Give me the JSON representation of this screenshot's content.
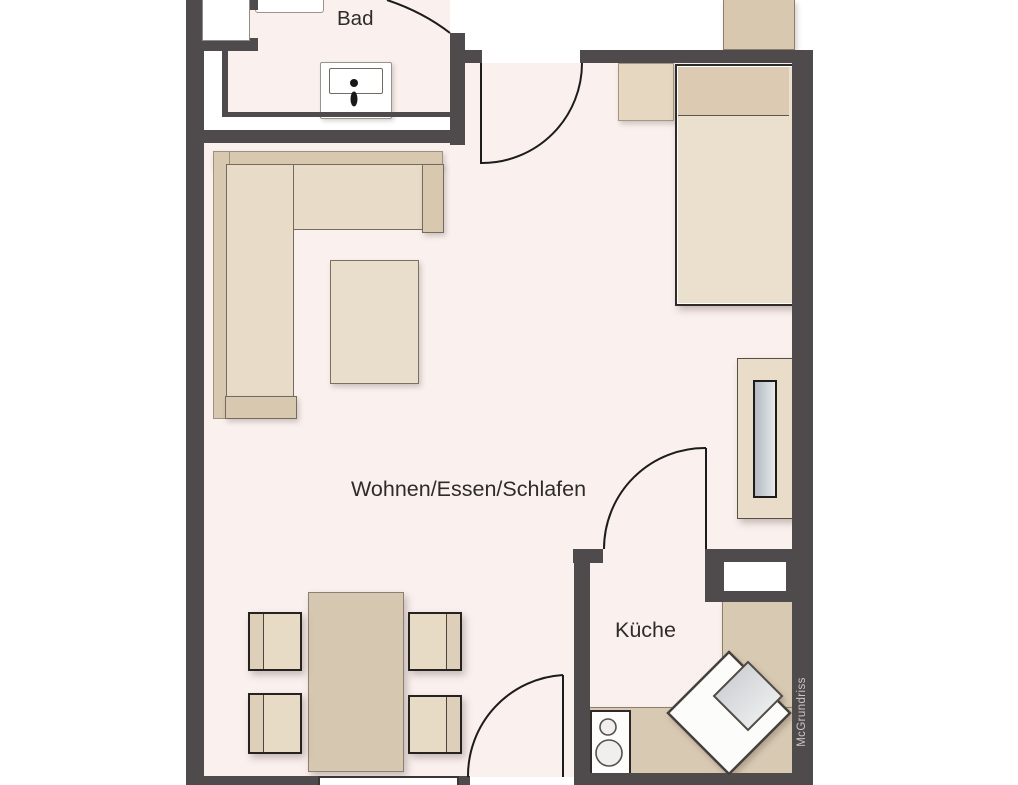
{
  "palette": {
    "background": "#ffffff",
    "floor": "#faf0ee",
    "wall": "#4f4b4c",
    "furniture_dark": "#d8c8b0",
    "furniture_light": "#e8dbc8",
    "counter": "#d8c9b2",
    "door_line": "#1c1c1c",
    "watermark_color": "#cbc7c3"
  },
  "rooms": {
    "bathroom": "Bad",
    "living": "Wohnen/Essen/Schlafen",
    "kitchen": "Küche"
  },
  "watermark": "McGrundriss"
}
